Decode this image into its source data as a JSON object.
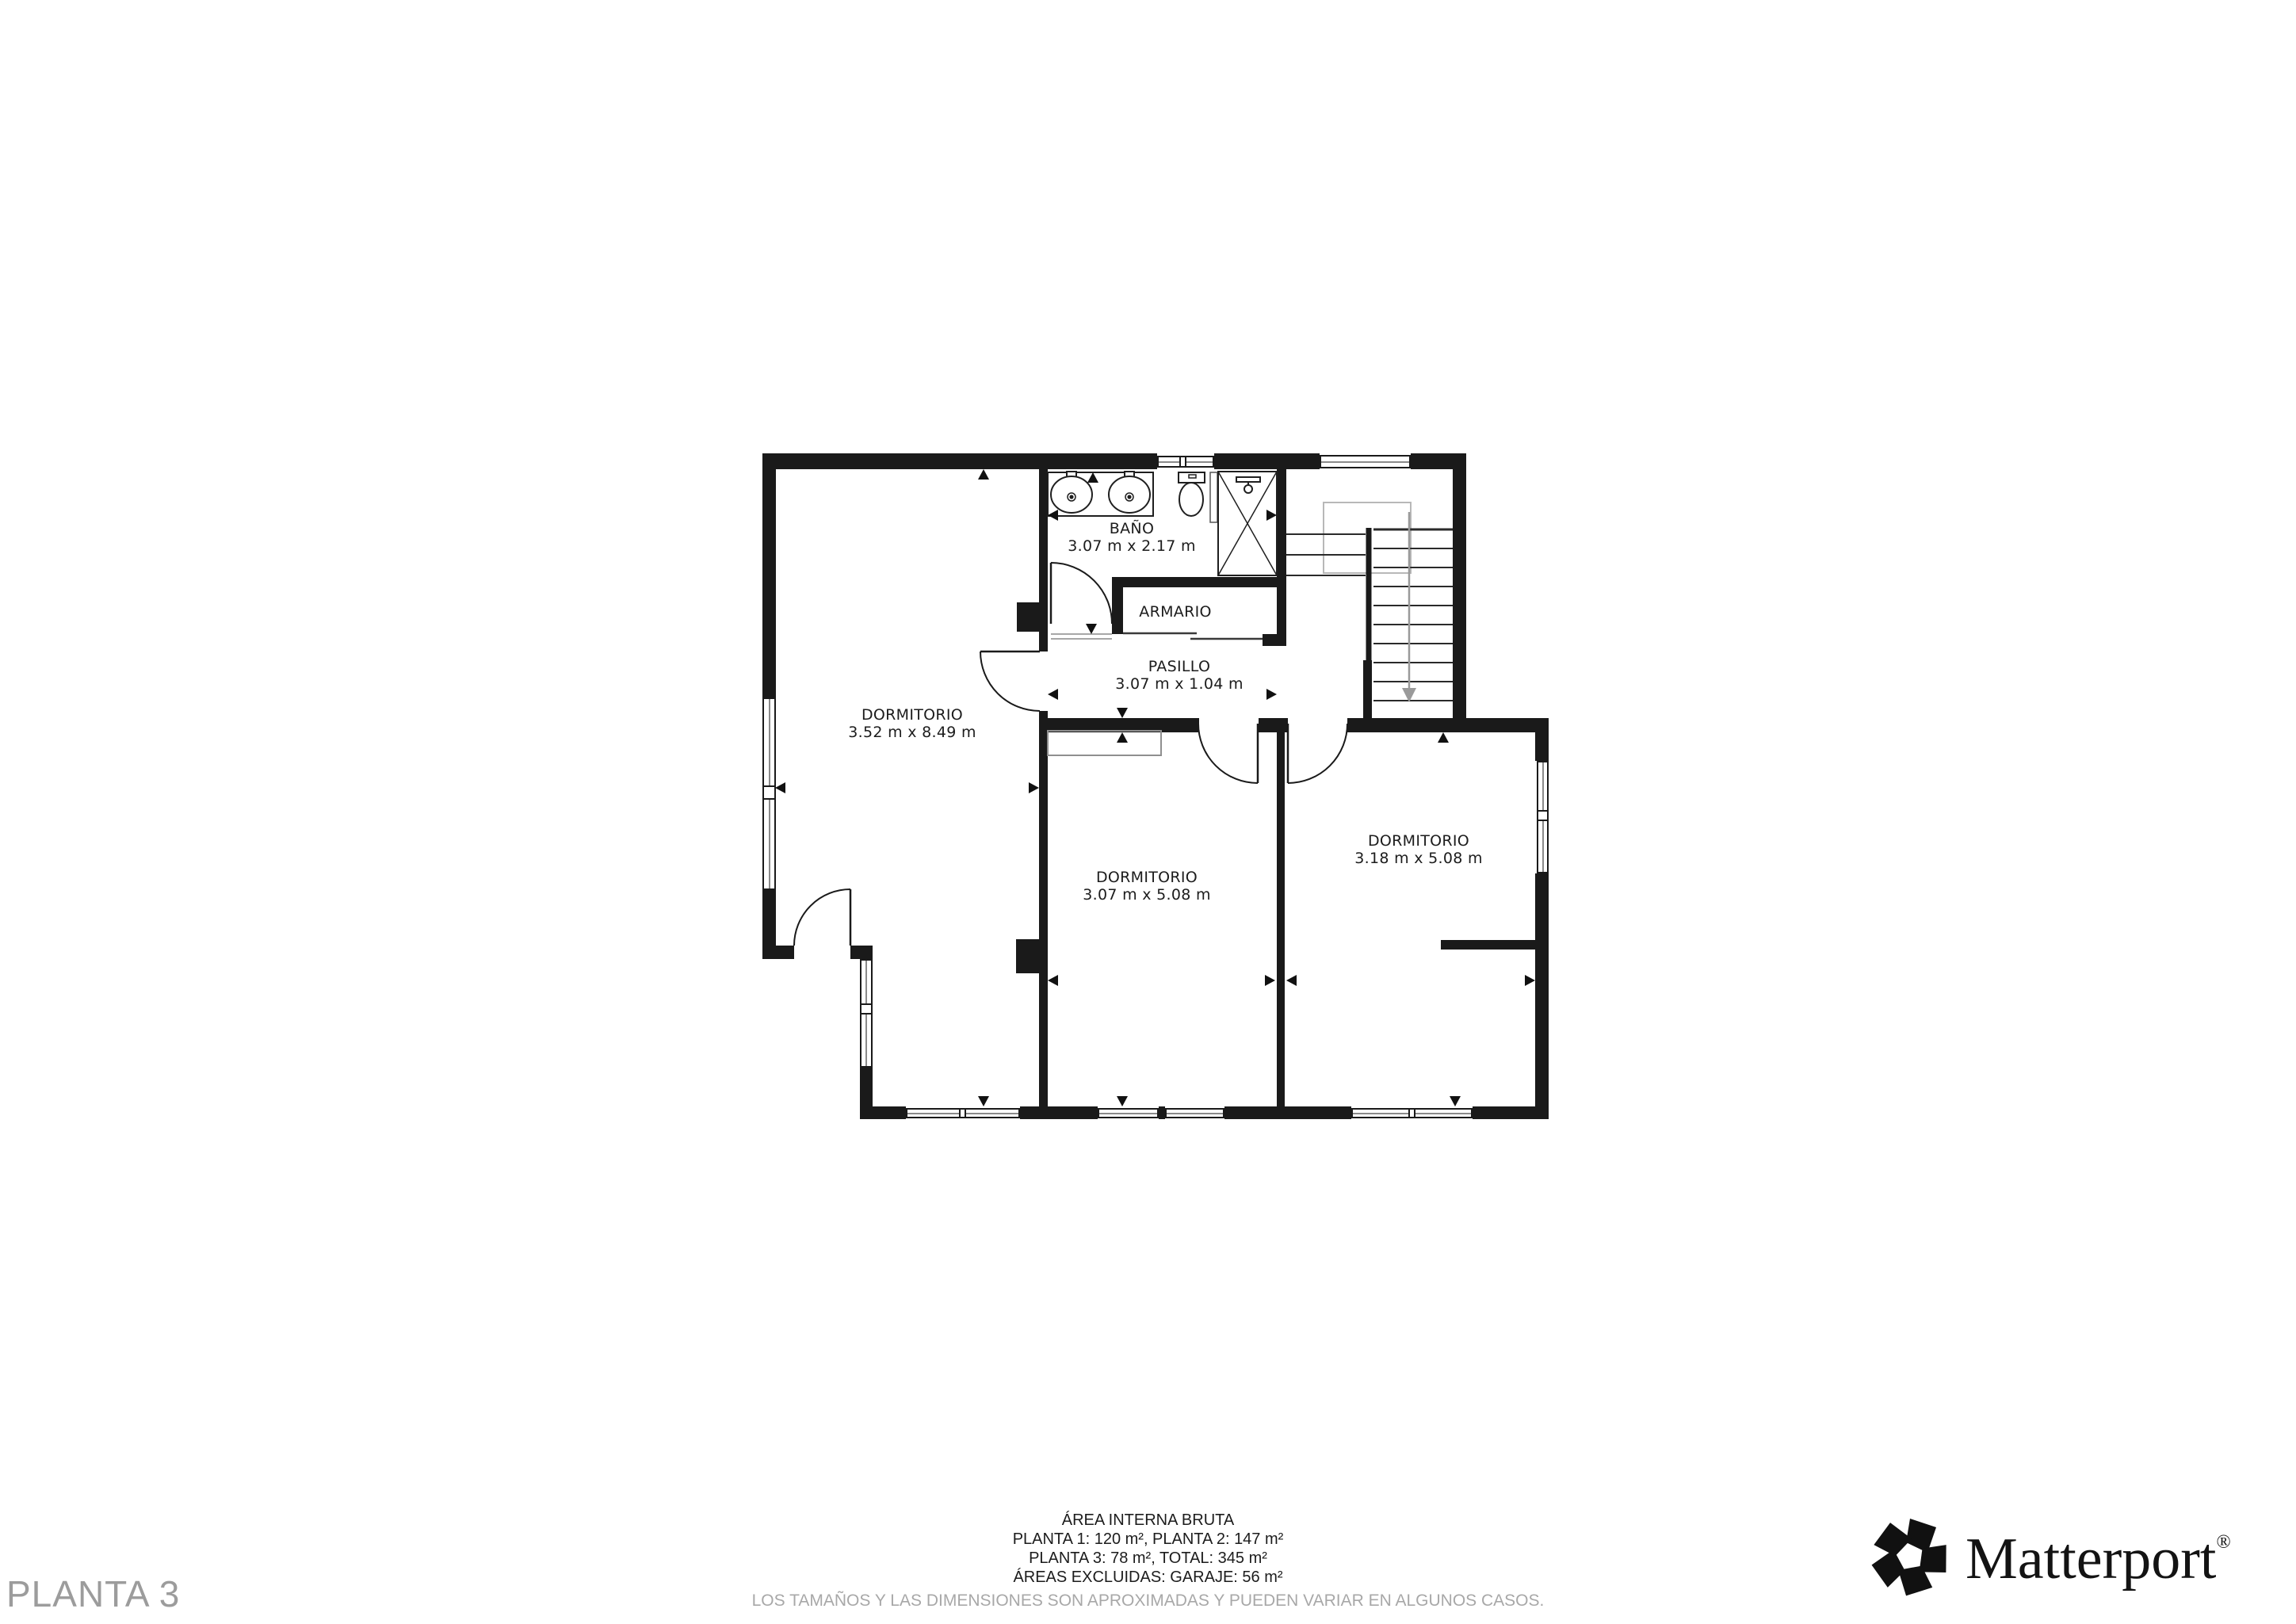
{
  "title": "PLANTA 3",
  "rooms": {
    "dormitorio_left": {
      "label": "DORMITORIO",
      "dims": "3.52 m x 8.49 m"
    },
    "bano": {
      "label": "BAÑO",
      "dims": "3.07 m x 2.17 m"
    },
    "armario": {
      "label": "ARMARIO"
    },
    "pasillo": {
      "label": "PASILLO",
      "dims": "3.07 m x 1.04 m"
    },
    "dormitorio_center": {
      "label": "DORMITORIO",
      "dims": "3.07 m x 5.08 m"
    },
    "dormitorio_right": {
      "label": "DORMITORIO",
      "dims": "3.18 m x 5.08 m"
    }
  },
  "footer": {
    "title": "ÁREA INTERNA BRUTA",
    "lines": [
      "PLANTA 1: 120 m², PLANTA 2: 147 m²",
      "PLANTA 3: 78 m², TOTAL: 345 m²",
      "ÁREAS EXCLUIDAS: GARAJE: 56 m²"
    ],
    "disclaimer": "LOS TAMAÑOS Y LAS DIMENSIONES SON APROXIMADAS Y PUEDEN VARIAR EN ALGUNOS CASOS."
  },
  "brand": {
    "wordmark": "Matterport",
    "registered": "®"
  },
  "colors": {
    "wall": "#1a1a1a",
    "label": "#1c1c1c",
    "muted": "#9c9c9c",
    "stair_arrow": "#9a9a9a"
  },
  "icons": {
    "sink": "sink-icon",
    "toilet": "toilet-icon",
    "shower": "shower-icon",
    "stairs": "stairs-icon",
    "door": "door-swing-icon",
    "dimension": "dimension-arrow-icon",
    "logo": "matterport-logo-icon"
  }
}
